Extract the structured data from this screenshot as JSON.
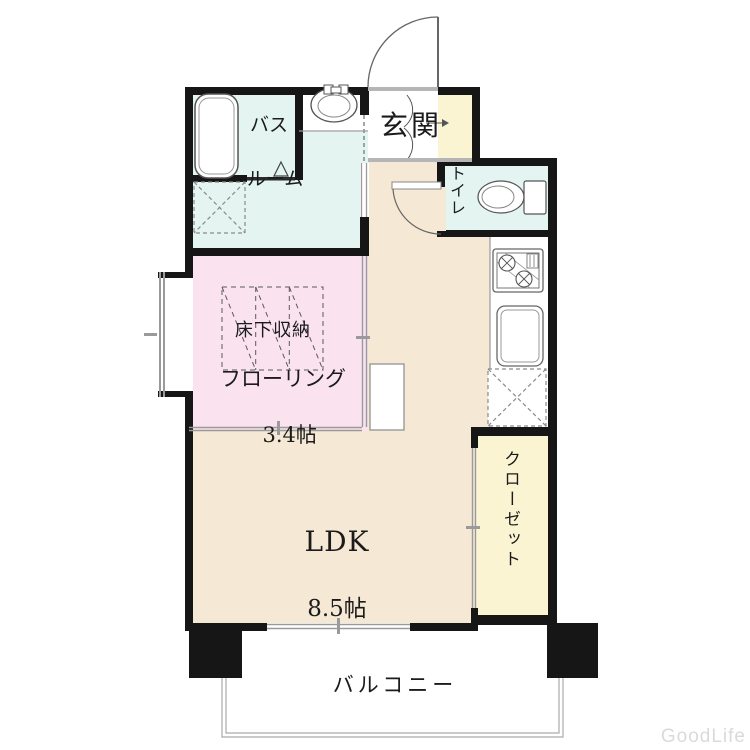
{
  "watermark": "GoodLife",
  "rooms": {
    "bathroom": {
      "line1": "バス",
      "line2": "ルーム"
    },
    "entrance": {
      "label": "玄関"
    },
    "toilet": {
      "label": "トイレ"
    },
    "flooring_room": {
      "storage_label": "床下収納",
      "name": "フローリング",
      "size": "3.4帖"
    },
    "ldk": {
      "name": "LDK",
      "size": "8.5帖"
    },
    "closet": {
      "label": "クローゼット"
    },
    "balcony": {
      "label": "バルコニー"
    }
  },
  "colors": {
    "wet_area": "#e3f4f1",
    "flooring_room": "#fae3ef",
    "ldk": "#f5e8d5",
    "closet_cream": "#fbf4d3",
    "wall": "#161616",
    "thin_line": "#8f8f8f"
  }
}
